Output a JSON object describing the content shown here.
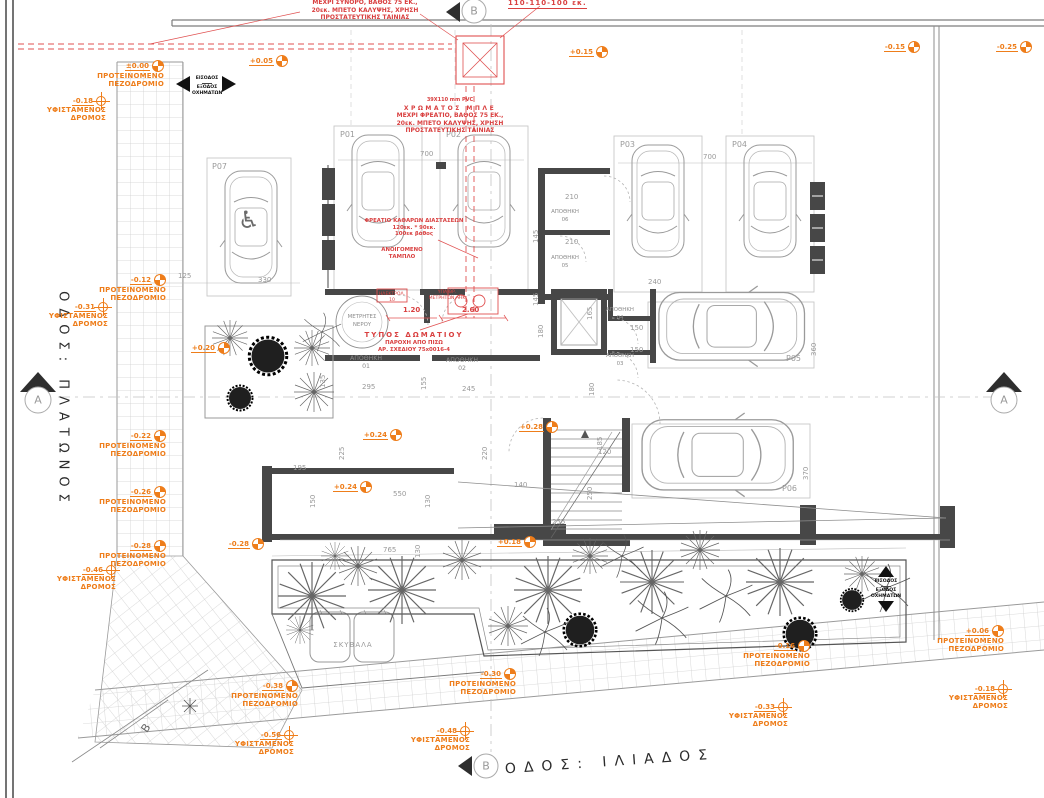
{
  "streets": {
    "left": "ΟΔΟΣ: ΠΛΑΤΩΝΟΣ",
    "bottom": "ΟΔΟΣ: ΙΛΙΑΔΟΣ"
  },
  "sections": {
    "a": "A",
    "b": "B"
  },
  "access": {
    "line1": "ΕΙΣΟΔΟΣ",
    "line2": "ΕΞΟΔΟΣ",
    "line3": "ΟΧΗΜΑΤΩΝ"
  },
  "marker_labels": {
    "sidewalk": [
      "ΠΡΟΤΕΙΝΟΜΕΝΟ",
      "ΠΕΖΟΔΡΟΜΙΟ"
    ],
    "road": [
      "ΥΦΙΣΤΑΜΕΝΟΣ",
      "ΔΡΟΜΟΣ"
    ]
  },
  "levels": [
    {
      "value": "±0.00"
    },
    {
      "value": "-0.18"
    },
    {
      "value": "-0.12"
    },
    {
      "value": "-0.31"
    },
    {
      "value": "-0.22"
    },
    {
      "value": "-0.26"
    },
    {
      "value": "-0.28"
    },
    {
      "value": "-0.46"
    },
    {
      "value": "+0.05"
    },
    {
      "value": "+0.15"
    },
    {
      "value": "-0.15"
    },
    {
      "value": "-0.25"
    },
    {
      "value": "+0.20"
    },
    {
      "value": "+0.24"
    },
    {
      "value": "+0.28"
    },
    {
      "value": "+0.24"
    },
    {
      "value": "-0.28"
    },
    {
      "value": "+0.18"
    },
    {
      "value": "-0.38"
    },
    {
      "value": "-0.56"
    },
    {
      "value": "-0.30"
    },
    {
      "value": "-0.48"
    },
    {
      "value": "-0.16"
    },
    {
      "value": "-0.33"
    },
    {
      "value": "+0.06"
    },
    {
      "value": "-0.18"
    }
  ],
  "parking_spots": [
    "P01",
    "P02",
    "P03",
    "P04",
    "P05",
    "P06",
    "P07"
  ],
  "rooms": {
    "storage": "ΑΠΟΘΗΚΗ",
    "storage_nums": [
      "01",
      "02",
      "03",
      "04",
      "05",
      "06"
    ],
    "water_meters": [
      "ΜΕΤΡΗΤΕΣ",
      "ΝΕΡΟΥ"
    ],
    "trash": "ΣΚΥΒΑΛΑ"
  },
  "red_notes": {
    "boundary": [
      "ΜΕΧΡΙ ΣΥΝΟΡΟ, ΒΑΘΟΣ 75 ΕΚ.,",
      "20εκ. ΜΠΕΤΟ ΚΑΛΥΨΗΣ, ΧΡΗΣΗ",
      "ΠΡΟΣΤΑΤΕΥΤΙΚΗΣ ΤΑΙΝΙΑΣ"
    ],
    "top_right": "110-110-100 εκ.",
    "pvc": [
      "39Χ110 mm PVC",
      "ΧΡΩΜΑΤΟΣ ΜΠΛΕ",
      "ΜΕΧΡΙ ΦΡΕΑΤΙΟ, ΒΑΘΟΣ 75 ΕΚ.,",
      "20εκ. ΜΠΕΤΟ ΚΑΛΥΨΗΣ, ΧΡΗΣΗ",
      "ΠΡΟΣΤΑΤΕΥΤΙΚΗΣ ΤΑΙΝΙΑΣ"
    ],
    "shaft": [
      "ΦΡΕΑΤΙΟ ΚΑΘΑΡΩΝ ΔΙΑΣΤΑΣΕΩΝ",
      "120εκ. * 90εκ.",
      "100εκ βάθος"
    ],
    "panel": [
      "ΑΝΟΙΓΟΜΕΝΟ",
      "ΤΑΜΠΛΟ"
    ],
    "room_type": [
      "ΤΥΠΟΣ ΔΩΜΑΤΙΟΥ",
      "ΠΑΡΟΧΗ ΑΠΟ ΠΙΣΩ",
      "ΑΡ. ΣΧΕΔΙΟΥ 75x0016-4"
    ],
    "elec": "ΗΛΕΚΤΡΟΛ. 10",
    "ahk": [
      "ΥΠΑΙΘΡ.",
      "ΜΕΤΡΗΤΩΝ ΑΗΚ"
    ],
    "dim1": "1.20",
    "dim2": "2.60"
  },
  "dims": [
    "125",
    "330",
    "700",
    "700",
    "240",
    "210",
    "145",
    "210",
    "145",
    "180",
    "150",
    "150",
    "165",
    "180",
    "360",
    "370",
    "295",
    "135",
    "245",
    "155",
    "185",
    "120",
    "225",
    "220",
    "195",
    "150",
    "550",
    "130",
    "140",
    "765",
    "130",
    "250",
    "255"
  ],
  "colors": {
    "accent_orange": "#EE7D1A",
    "annotation_red": "#D94040",
    "wall": "#474747"
  }
}
